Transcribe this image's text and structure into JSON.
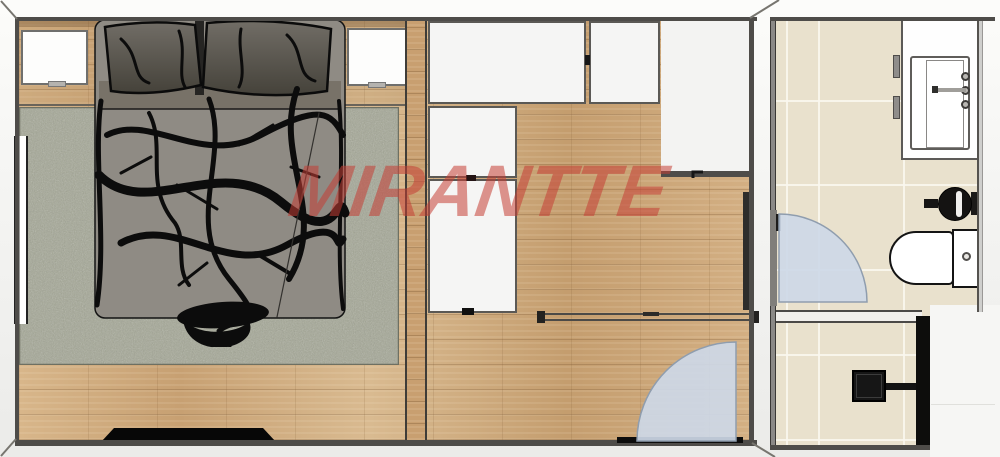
{
  "watermark": {
    "text": "MIRANTTE",
    "color_hex": "#c43e34",
    "style": "bold-italic-semi-transparent"
  },
  "floor_plan": {
    "type": "bedroom-suite-top-view-render",
    "rooms": [
      {
        "label": "bedroom",
        "floor_finish": "wood-planks",
        "items": [
          "double-bed",
          "pillow-left",
          "pillow-right",
          "nightstand-left",
          "nightstand-right",
          "area-rug",
          "wall-window",
          "flat-tv",
          "entry-door-swing"
        ]
      },
      {
        "label": "closet-area",
        "floor_finish": "wood-planks",
        "items": [
          "wardrobe-top-left",
          "wardrobe-top-right",
          "wardrobe-side-upper",
          "wardrobe-side-lower",
          "hallway-nook",
          "sliding-door-track"
        ]
      },
      {
        "label": "bathroom",
        "floor_finish": "ceramic-tile",
        "items": [
          "vanity-counter",
          "sink-basin",
          "faucet",
          "faucet-knobs",
          "round-black-basin",
          "toilet",
          "door-swing",
          "shower-head",
          "shower-wall-profile"
        ]
      }
    ],
    "palette": {
      "wood_floor": "#cda87b",
      "rug": "#a4a795",
      "bathroom_tile": "#e9e1cd",
      "bed_duvet": "#8f8b84",
      "fixture_black": "#111111",
      "door_swing_fill": "#cdd8e7",
      "wall_line": "#4e4c49"
    }
  }
}
